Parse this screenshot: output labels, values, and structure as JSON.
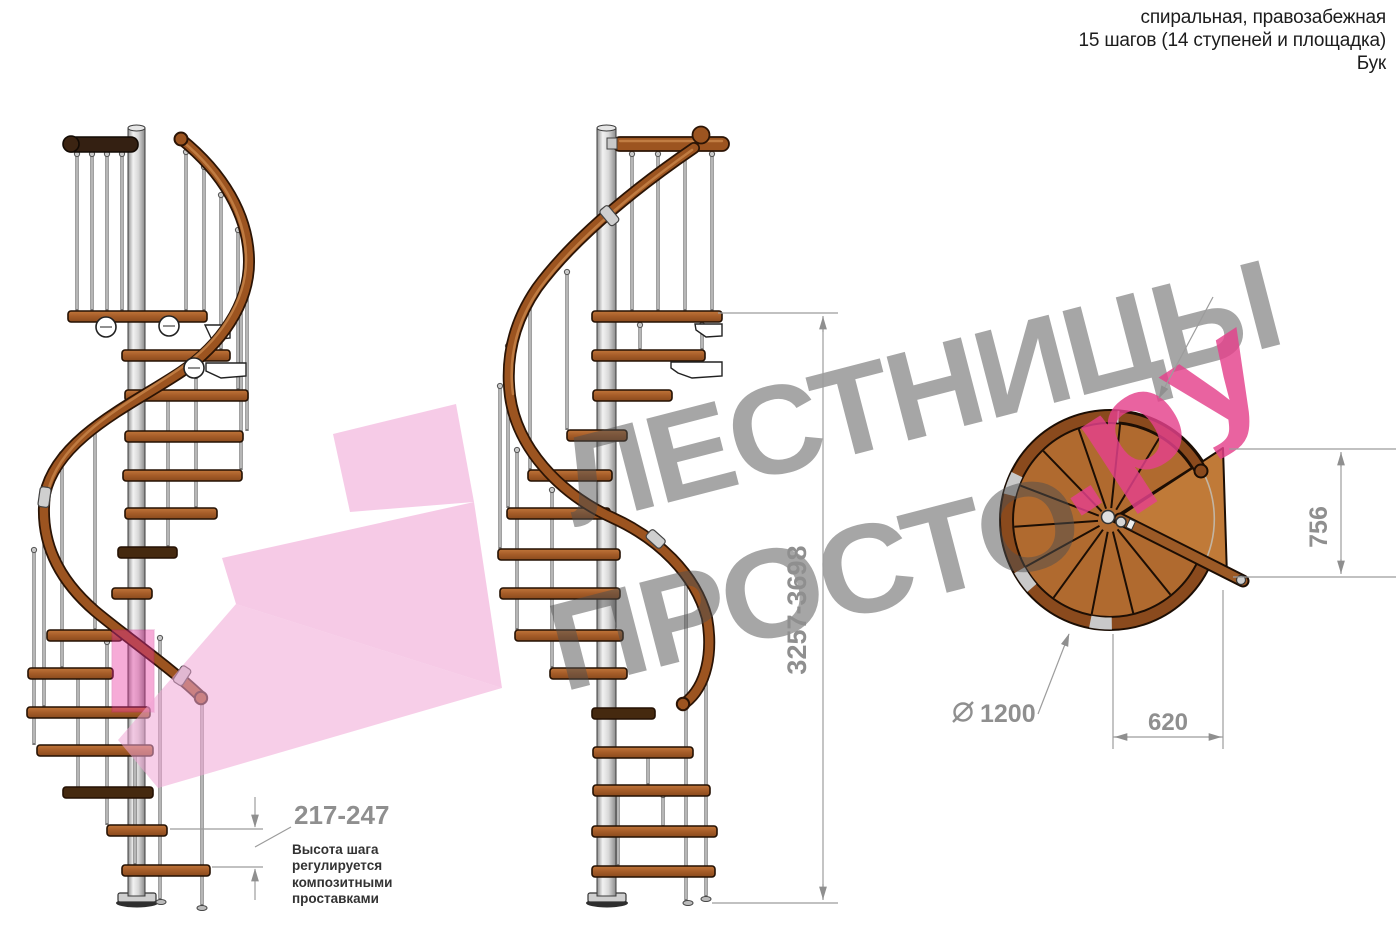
{
  "header": {
    "line1": "спиральная, правозабежная",
    "line2": "15 шагов (14 ступеней и площадка)",
    "line3": "Бук"
  },
  "watermark": {
    "word1": "ЛЕСТНИЦЫ",
    "word2": "ПРОСТО",
    "word3": ".ру"
  },
  "dimensions": {
    "total_height": "3257-3698",
    "step_height": "217-247",
    "step_height_note": "Высота шага регулируется композитными проставками",
    "landing_depth": "756",
    "step_width": "620",
    "diameter": "1200",
    "diameter_symbol": "∅"
  },
  "colors": {
    "watermark_gray": "#9c9c9c",
    "accent_pink": "#e5418c",
    "ribbon_pink": "#f0a6d6",
    "wood": "#a55c28",
    "wood_dark": "#45290f",
    "rail_wood": "#9c5420",
    "metal_light": "#e8e8e8",
    "dimension_gray": "#8f8f8f",
    "text_dark": "#1c1c1c"
  }
}
